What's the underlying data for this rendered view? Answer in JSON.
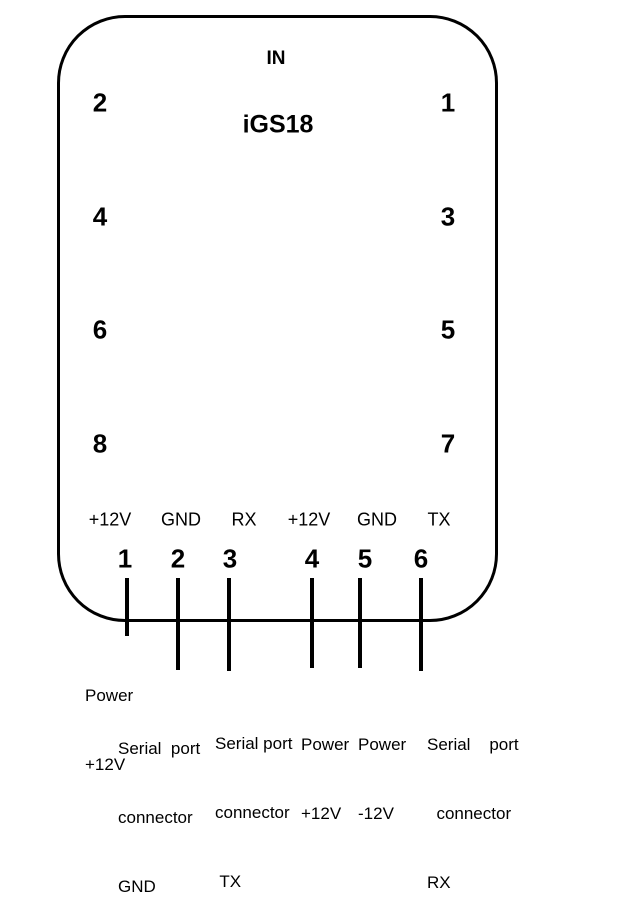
{
  "diagram": {
    "background_color": "#ffffff",
    "line_color": "#000000"
  },
  "device": {
    "top_label": "IN",
    "title": "iGS18",
    "left_pin_numbers": [
      "2",
      "4",
      "6",
      "8"
    ],
    "right_pin_numbers": [
      "1",
      "3",
      "5",
      "7"
    ]
  },
  "connector": {
    "pin_labels": [
      "+12V",
      "GND",
      "RX",
      "+12V",
      "GND",
      "TX"
    ],
    "pin_numbers": [
      "1",
      "2",
      "3",
      "4",
      "5",
      "6"
    ],
    "wire_descriptions": [
      {
        "lines": [
          "Power",
          "+12V"
        ]
      },
      {
        "lines": [
          "Serial  port",
          "connector",
          "GND"
        ]
      },
      {
        "lines": [
          "Serial port",
          "connector",
          " TX"
        ]
      },
      {
        "lines": [
          "Power",
          "+12V"
        ]
      },
      {
        "lines": [
          "Power",
          "-12V"
        ]
      },
      {
        "lines": [
          "Serial    port",
          "  connector",
          "RX"
        ]
      }
    ]
  }
}
